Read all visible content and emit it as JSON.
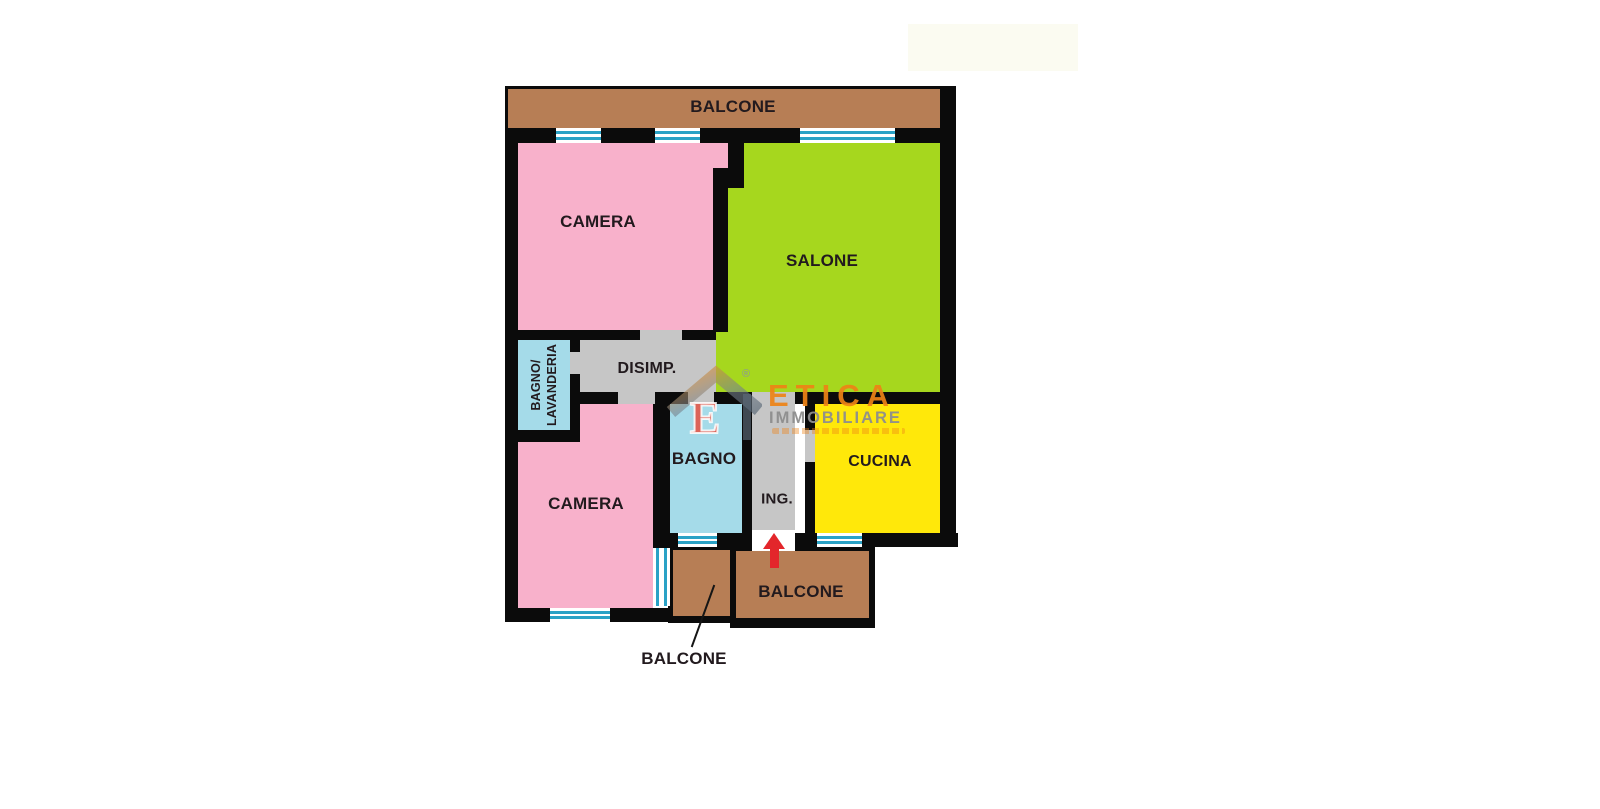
{
  "page": {
    "background": "#FFFFFF",
    "type": "apartment floor plan"
  },
  "floorplan": {
    "labels": {
      "balcone_top": "BALCONE",
      "camera_top": "CAMERA",
      "salone": "SALONE",
      "bagno_lavanderia_line1": "BAGNO/",
      "bagno_lavanderia_line2": "LAVANDERIA",
      "disimpegno": "DISIMP.",
      "camera_bottom": "CAMERA",
      "bagno": "BAGNO",
      "ingresso": "ING.",
      "cucina": "CUCINA",
      "balcone_big": "BALCONE",
      "balcone_small": "BALCONE"
    },
    "colors": {
      "wall": "#0B0B0B",
      "camera_pink": "#F8B1CB",
      "salone_green": "#A6D71E",
      "cucina_yellow": "#FFE80A",
      "bagno_blue": "#A5DBE9",
      "corridor_gray": "#C6C6C6",
      "balcony_brown": "#B77E55",
      "window_line_teal": "#2AA2C6",
      "entrance_arrow_red": "#E3262B",
      "label_text": "#221A1E"
    }
  },
  "watermark": {
    "brand": "ETICA",
    "brand_suffix": "IMMOBILIARE",
    "monogram": "E",
    "registered_mark": "®",
    "brand_orange": "#EE8316",
    "brand_gray": "#8E8E8E",
    "tagline_legible": false
  }
}
